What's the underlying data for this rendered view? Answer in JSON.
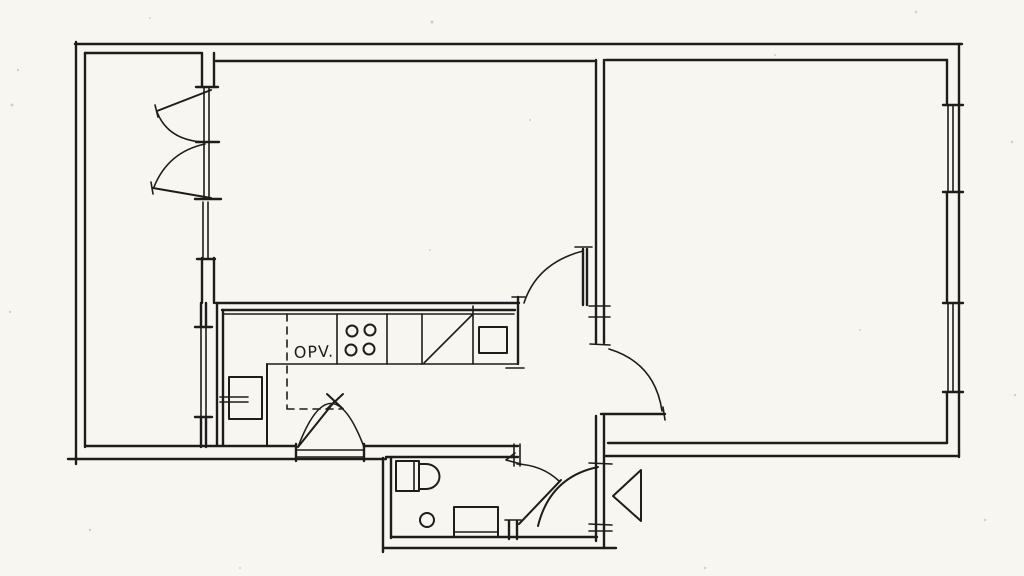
{
  "palette": {
    "paper": "#f8f6f1",
    "ink": "#1e1d1b",
    "speck": "#c8c2b6"
  },
  "plan": {
    "type": "hand-drawn apartment floor plan (scanned ink sketch)",
    "labels": {
      "opv": "OPV."
    },
    "rooms_visible_count": 5,
    "fixtures": [
      "balcony-french-doors",
      "balcony-partition-windows",
      "kitchen-counter",
      "dishwasher-dashed-outline",
      "stove-four-burners",
      "sink-with-drainer-diagonal",
      "vent-shaft-square",
      "kitchen-base-cabinet",
      "kitchen-service-door",
      "living-room-to-hall-door",
      "hall-to-room-door",
      "front-door",
      "entrance-direction-arrow",
      "toilet",
      "floor-drain",
      "washing-machine",
      "facade-window-upper",
      "facade-window-lower"
    ]
  }
}
